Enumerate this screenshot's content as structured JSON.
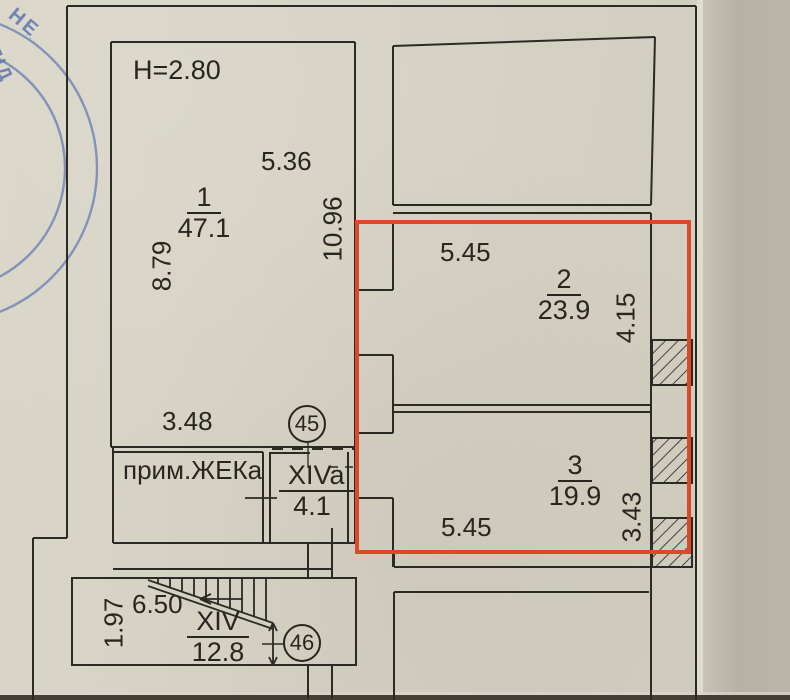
{
  "labels": {
    "ceiling_height": "H=2.80",
    "zheka_room": "прим.ЖЕКа"
  },
  "dimensions": {
    "room1_top_width": "5.36",
    "room1_left_height": "8.79",
    "room1_right_height": "10.96",
    "room1_bottom_width": "3.48",
    "room2_top_width": "5.45",
    "room2_right_height": "4.15",
    "room3_bottom_width": "5.45",
    "room3_right_height": "3.43",
    "stairs_width": "6.50",
    "stairs_height": "1.97"
  },
  "rooms": [
    {
      "number": "1",
      "area": "47.1"
    },
    {
      "number": "2",
      "area": "23.9"
    },
    {
      "number": "3",
      "area": "19.9"
    },
    {
      "number": "XIVa",
      "area": "4.1"
    },
    {
      "number": "XIV",
      "area": "12.8"
    }
  ],
  "markers": {
    "unit45": "45",
    "unit46": "46"
  },
  "stamp": {
    "word1": "НЕ",
    "word2": "ПІД",
    "micro": "····"
  },
  "colors": {
    "highlight_red": "#dd4829",
    "ink": "#2c2a25",
    "stamp_blue": "#5d76b3",
    "paper": "#d5d1c3"
  }
}
